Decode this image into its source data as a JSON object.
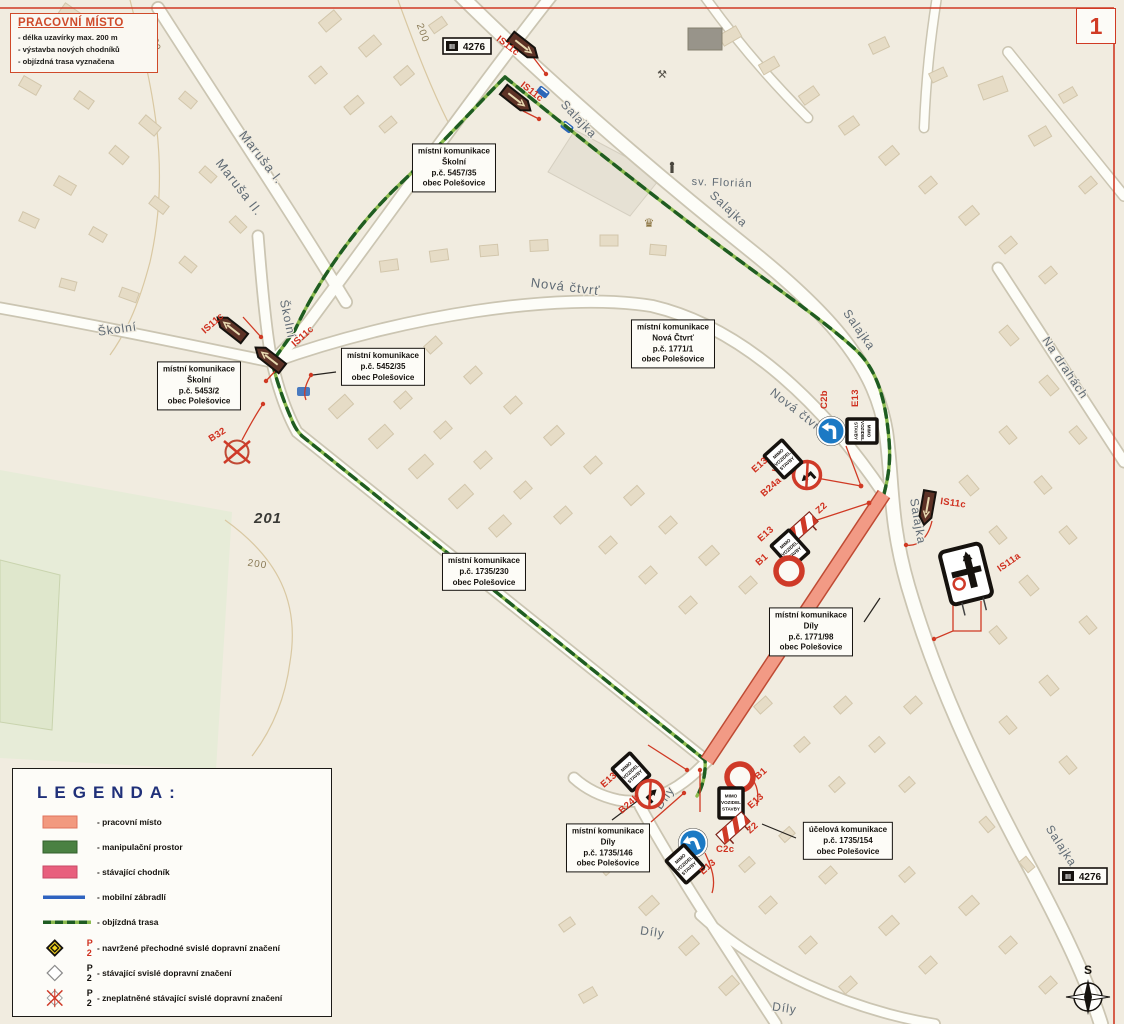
{
  "page": {
    "sheet_number": "1"
  },
  "worksite_box": {
    "title": "PRACOVNÍ MÍSTO",
    "bullets": [
      "- délka uzavírky max. 200 m",
      "- výstavba nových chodníků",
      "- objízdná trasa vyznačena"
    ]
  },
  "legend": {
    "title": "LEGENDA:",
    "items": [
      {
        "kind": "worksite",
        "label": "- pracovní místo"
      },
      {
        "kind": "manipulation",
        "label": "- manipulační prostor"
      },
      {
        "kind": "sidewalk",
        "label": "- stávající chodník"
      },
      {
        "kind": "barrier",
        "label": "- mobilní zábradlí"
      },
      {
        "kind": "detour",
        "label": "- objízdná trasa"
      },
      {
        "kind": "sign-proposed",
        "sign_code": "P 2",
        "label": "- navržené přechodné svislé dopravní značení"
      },
      {
        "kind": "sign-existing",
        "sign_code": "P 2",
        "label": "- stávající svislé dopravní značení"
      },
      {
        "kind": "sign-invalid",
        "sign_code": "P 2",
        "label": "- zneplatněné stávající svislé dopravní značení"
      }
    ]
  },
  "colors": {
    "worksite": "#f2997f",
    "manipulation": "#4a8142",
    "sidewalk": "#e85f7d",
    "barrier": "#2f63c0",
    "detour_dark": "#1f5c22",
    "detour_light": "#8cbb4f",
    "annotation_red": "#d03a24"
  },
  "callouts": [
    {
      "x": 454,
      "y": 168,
      "lines": [
        "místní komunikace",
        "Školní",
        "p.č. 5457/35",
        "obec Polešovice"
      ]
    },
    {
      "x": 673,
      "y": 344,
      "lines": [
        "místní komunikace",
        "Nová Čtvrť",
        "p.č. 1771/1",
        "obec Polešovice"
      ]
    },
    {
      "x": 199,
      "y": 386,
      "lines": [
        "místní komunikace",
        "Školní",
        "p.č. 5453/2",
        "obec Polešovice"
      ]
    },
    {
      "x": 383,
      "y": 367,
      "lines": [
        "místní komunikace",
        "p.č. 5452/35",
        "obec Polešovice"
      ]
    },
    {
      "x": 484,
      "y": 572,
      "lines": [
        "místní komunikace",
        "p.č. 1735/230",
        "obec Polešovice"
      ]
    },
    {
      "x": 811,
      "y": 632,
      "lines": [
        "místní komunikace",
        "Díly",
        "p.č. 1771/98",
        "obec Polešovice"
      ]
    },
    {
      "x": 608,
      "y": 848,
      "lines": [
        "místní komunikace",
        "Díly",
        "p.č. 1735/146",
        "obec Polešovice"
      ]
    },
    {
      "x": 848,
      "y": 841,
      "lines": [
        "účelová komunikace",
        "p.č. 1735/154",
        "obec Polešovice"
      ]
    }
  ],
  "street_labels": [
    {
      "text": "Maruša I.",
      "x": 258,
      "y": 160,
      "rot": 52,
      "size": 13
    },
    {
      "text": "Maruša II.",
      "x": 236,
      "y": 190,
      "rot": 52,
      "size": 13
    },
    {
      "text": "Školní",
      "x": 118,
      "y": 333,
      "rot": -8,
      "size": 12
    },
    {
      "text": "Školní",
      "x": 284,
      "y": 320,
      "rot": 78,
      "size": 12
    },
    {
      "text": "Nová čtvrť",
      "x": 565,
      "y": 291,
      "rot": 7,
      "size": 13
    },
    {
      "text": "Nová čtvrť",
      "x": 795,
      "y": 414,
      "rot": 38,
      "size": 12
    },
    {
      "text": "Salajka",
      "x": 576,
      "y": 122,
      "rot": 47,
      "size": 12
    },
    {
      "text": "Salajka",
      "x": 726,
      "y": 212,
      "rot": 43,
      "size": 12
    },
    {
      "text": "Salajka",
      "x": 856,
      "y": 332,
      "rot": 55,
      "size": 12
    },
    {
      "text": "Salajka",
      "x": 914,
      "y": 522,
      "rot": 80,
      "size": 12
    },
    {
      "text": "Salajka",
      "x": 1058,
      "y": 848,
      "rot": 57,
      "size": 12
    },
    {
      "text": "Na drahách",
      "x": 1062,
      "y": 370,
      "rot": 56,
      "size": 12
    },
    {
      "text": "Díly",
      "x": 668,
      "y": 800,
      "rot": -55,
      "size": 12
    },
    {
      "text": "Díly",
      "x": 652,
      "y": 936,
      "rot": 8,
      "size": 12
    },
    {
      "text": "Díly",
      "x": 784,
      "y": 1012,
      "rot": 8,
      "size": 12
    },
    {
      "text": "sv. Florián",
      "x": 722,
      "y": 186,
      "rot": 2,
      "size": 11
    },
    {
      "text": "201",
      "x": 268,
      "y": 523,
      "rot": 0,
      "size": 15,
      "cls": "parcel"
    },
    {
      "text": "200",
      "x": 152,
      "y": 42,
      "rot": 75,
      "size": 10,
      "cls": "contour"
    },
    {
      "text": "200",
      "x": 420,
      "y": 34,
      "rot": 70,
      "size": 10,
      "cls": "contour"
    },
    {
      "text": "200",
      "x": 257,
      "y": 567,
      "rot": 8,
      "size": 10,
      "cls": "contour"
    }
  ],
  "road_shields": [
    {
      "prefix": "III",
      "number": "4276",
      "x": 467,
      "y": 46
    },
    {
      "prefix": "III",
      "number": "4276",
      "x": 1083,
      "y": 876
    }
  ],
  "e13_text": [
    "MIMO",
    "VOZIDEL",
    "STAVBY"
  ],
  "signs": [
    {
      "code": "IS11c",
      "type": "is11c",
      "x": 524,
      "y": 47,
      "rot": 38,
      "lx": 496,
      "ly": 40,
      "lrot": 38
    },
    {
      "code": "IS11c",
      "type": "is11c",
      "x": 517,
      "y": 100,
      "rot": 38,
      "lx": 520,
      "ly": 86,
      "lrot": 38
    },
    {
      "code": "IS11c",
      "type": "is11c",
      "x": 231,
      "y": 328,
      "rot": 218,
      "lx": 205,
      "ly": 334,
      "lrot": -42
    },
    {
      "code": "IS11c",
      "type": "is11c",
      "x": 269,
      "y": 358,
      "rot": 218,
      "lx": 295,
      "ly": 347,
      "lrot": -42
    },
    {
      "code": "IS11c",
      "type": "is11c",
      "x": 927,
      "y": 508,
      "rot": 100,
      "lx": 940,
      "ly": 504,
      "lrot": 8
    },
    {
      "code": "IS11a",
      "type": "is11a",
      "x": 966,
      "y": 574,
      "rot": -14,
      "lx": 1000,
      "ly": 572,
      "lrot": -35
    },
    {
      "code": "B32",
      "type": "b32",
      "x": 237,
      "y": 452,
      "rot": 0,
      "lx": 211,
      "ly": 442,
      "lrot": -32
    },
    {
      "code": "C2b",
      "type": "c2b",
      "x": 831,
      "y": 431,
      "rot": 0,
      "lx": 827,
      "ly": 409,
      "lrot": -90
    },
    {
      "code": "E13",
      "type": "e13",
      "x": 862,
      "y": 431,
      "rot": 90,
      "lx": 858,
      "ly": 407,
      "lrot": -90
    },
    {
      "code": "B24a",
      "type": "b24a",
      "x": 807,
      "y": 475,
      "rot": -42,
      "lx": 764,
      "ly": 497,
      "lrot": -42
    },
    {
      "code": "E13",
      "type": "e13",
      "x": 783,
      "y": 459,
      "rot": -42,
      "lx": 755,
      "ly": 473,
      "lrot": -42
    },
    {
      "code": "Z2",
      "type": "z2",
      "x": 801,
      "y": 528,
      "rot": -42,
      "lx": 819,
      "ly": 514,
      "lrot": -42
    },
    {
      "code": "E13",
      "type": "e13",
      "x": 790,
      "y": 549,
      "rot": -42,
      "lx": 761,
      "ly": 542,
      "lrot": -42
    },
    {
      "code": "B1",
      "type": "b1",
      "x": 789,
      "y": 571,
      "rot": 0,
      "lx": 759,
      "ly": 566,
      "lrot": -42
    },
    {
      "code": "E13",
      "type": "e13",
      "x": 631,
      "y": 772,
      "rot": -42,
      "lx": 604,
      "ly": 788,
      "lrot": -42
    },
    {
      "code": "B24b",
      "type": "b24b",
      "x": 650,
      "y": 794,
      "rot": -42,
      "lx": 622,
      "ly": 814,
      "lrot": -42
    },
    {
      "code": "B1",
      "type": "b1",
      "x": 740,
      "y": 777,
      "rot": 0,
      "lx": 758,
      "ly": 780,
      "lrot": -42
    },
    {
      "code": "E13",
      "type": "e13",
      "x": 731,
      "y": 803,
      "rot": 0,
      "lx": 751,
      "ly": 809,
      "lrot": -42
    },
    {
      "code": "Z2",
      "type": "z2",
      "x": 733,
      "y": 828,
      "rot": -42,
      "lx": 750,
      "ly": 834,
      "lrot": -42
    },
    {
      "code": "C2c",
      "type": "c2c",
      "x": 693,
      "y": 843,
      "rot": -20,
      "lx": 716,
      "ly": 852,
      "lrot": 0
    },
    {
      "code": "E13",
      "type": "e13",
      "x": 685,
      "y": 864,
      "rot": -42,
      "lx": 703,
      "ly": 875,
      "lrot": -42
    }
  ],
  "compass": {
    "label": "S"
  }
}
